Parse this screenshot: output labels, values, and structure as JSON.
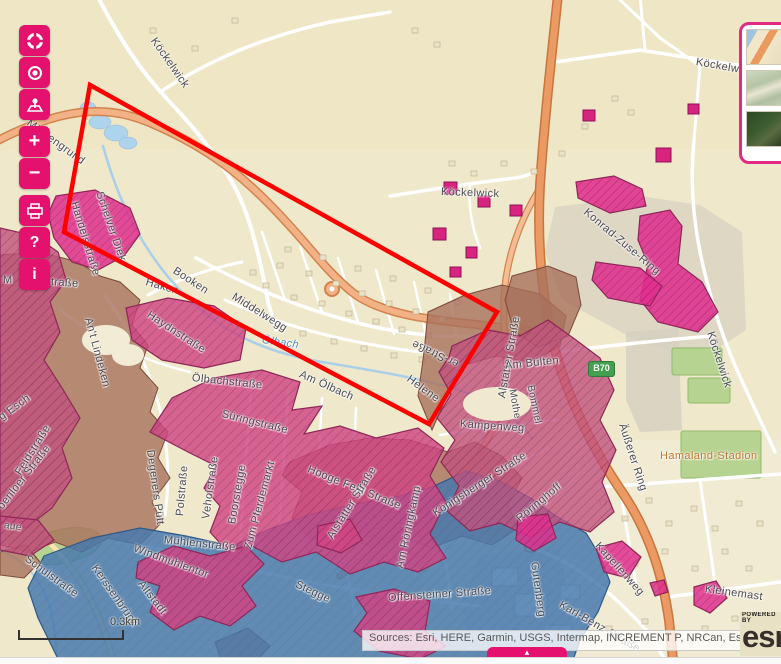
{
  "window": {
    "width": 781,
    "height": 663
  },
  "theme": {
    "accent_pink": "#e5116e",
    "widget_border_pink": "#e02a86",
    "annotation_red": "#ff0000",
    "zone_rose": "#c2517e",
    "zone_crimson": "#d04583",
    "zone_magenta": "#df2f8c",
    "zone_brown": "#a8705c",
    "zone_blue": "#4679ae",
    "basemap_cream": "#efe8cb",
    "road_orange": "#eb9a63",
    "badge_green": "#44a04e"
  },
  "toolbar": {
    "buttons": [
      {
        "id": "default-extent",
        "icon": "extent-icon",
        "glyph": ""
      },
      {
        "id": "my-location",
        "icon": "target-icon",
        "glyph": ""
      },
      {
        "id": "map-pin",
        "icon": "map-pin-icon",
        "glyph": ""
      },
      {
        "id": "zoom-in",
        "icon": "",
        "glyph": "+",
        "group_start": true
      },
      {
        "id": "zoom-out",
        "icon": "",
        "glyph": "−"
      },
      {
        "id": "print",
        "icon": "printer-icon",
        "glyph": "",
        "group_start": true
      },
      {
        "id": "help",
        "icon": "",
        "glyph": "?"
      },
      {
        "id": "info",
        "icon": "",
        "glyph": "i"
      }
    ]
  },
  "basemap_gallery": {
    "thumbnails": [
      "streets",
      "topographic",
      "imagery"
    ]
  },
  "map": {
    "scale_label": "0.3km",
    "route_badge": "B70",
    "attribution": "Sources: Esri, HERE, Garmin, USGS, Intermap, INCREMENT P, NRCan, Esri ...",
    "powered_by": "POWERED BY",
    "esri_logo": "esri",
    "panel_toggle_glyph": "▲",
    "labels": [
      {
        "text": "Köckelwick",
        "x": 153,
        "y": 33,
        "rot": 55
      },
      {
        "text": "Mühlengrund",
        "x": 28,
        "y": 116,
        "rot": 36
      },
      {
        "text": "Handelsstraße",
        "x": 74,
        "y": 196,
        "rot": 73
      },
      {
        "text": "Köckelwick",
        "x": 441,
        "y": 186,
        "rot": 2
      },
      {
        "text": "Köckelw",
        "x": 696,
        "y": 56,
        "rot": 10
      },
      {
        "text": "Konrad-Zuse-Ring",
        "x": 585,
        "y": 205,
        "rot": 40
      },
      {
        "text": "Alstätter Straße",
        "x": 502,
        "y": 392,
        "rot": -80
      },
      {
        "text": "Schelver Diek",
        "x": 99,
        "y": 186,
        "rot": 71
      },
      {
        "text": "Haken",
        "x": 146,
        "y": 276,
        "rot": 16
      },
      {
        "text": "Booken",
        "x": 174,
        "y": 264,
        "rot": 33
      },
      {
        "text": "Middelwegg",
        "x": 233,
        "y": 290,
        "rot": 32
      },
      {
        "text": "Ölbach",
        "x": 262,
        "y": 334,
        "rot": 8,
        "cls": "water"
      },
      {
        "text": "Am Ölbach",
        "x": 300,
        "y": 368,
        "rot": 24
      },
      {
        "text": "Ölbachstraße",
        "x": 192,
        "y": 372,
        "rot": 6
      },
      {
        "text": "Süringstraße",
        "x": 222,
        "y": 408,
        "rot": 14
      },
      {
        "text": "Haydnstraße",
        "x": 148,
        "y": 308,
        "rot": 33
      },
      {
        "text": "An't Lindeken",
        "x": 88,
        "y": 312,
        "rot": 75
      },
      {
        "text": "M",
        "x": 3,
        "y": 274,
        "rot": 0
      },
      {
        "text": "traße",
        "x": 51,
        "y": 276,
        "rot": 4
      },
      {
        "text": "g Esch",
        "x": 0,
        "y": 412,
        "rot": -36
      },
      {
        "text": "Feldstraße",
        "x": 18,
        "y": 468,
        "rot": -58
      },
      {
        "text": "oenloer Straße",
        "x": 0,
        "y": 502,
        "rot": -52
      },
      {
        "text": "Polstraße",
        "x": 180,
        "y": 510,
        "rot": -85
      },
      {
        "text": "Degeners Pütt",
        "x": 150,
        "y": 444,
        "rot": 82
      },
      {
        "text": "Veholstraße",
        "x": 206,
        "y": 513,
        "rot": -82
      },
      {
        "text": "Boorstegge",
        "x": 232,
        "y": 518,
        "rot": -80
      },
      {
        "text": "Zum Pferdemarkt",
        "x": 248,
        "y": 543,
        "rot": -75
      },
      {
        "text": "Hooge Feld Straße",
        "x": 308,
        "y": 463,
        "rot": 22
      },
      {
        "text": "Alstätter Straße",
        "x": 330,
        "y": 532,
        "rot": -58
      },
      {
        "text": "Am Röringkamp",
        "x": 400,
        "y": 562,
        "rot": -78
      },
      {
        "text": "Mühlenstraße",
        "x": 164,
        "y": 534,
        "rot": 6
      },
      {
        "text": "Windmühlentor",
        "x": 134,
        "y": 542,
        "rot": 20
      },
      {
        "text": "Altstadt",
        "x": 140,
        "y": 576,
        "rot": 52
      },
      {
        "text": "Stegge",
        "x": 296,
        "y": 578,
        "rot": 25
      },
      {
        "text": "Offensteiner Straße",
        "x": 388,
        "y": 592,
        "rot": -4
      },
      {
        "text": "Kerssenbrück",
        "x": 94,
        "y": 560,
        "rot": 55
      },
      {
        "text": "Schulstraße",
        "x": 26,
        "y": 552,
        "rot": 36
      },
      {
        "text": "aue",
        "x": 4,
        "y": 520,
        "rot": 8,
        "cls": "small"
      },
      {
        "text": "Am Bülten",
        "x": 505,
        "y": 360,
        "rot": -6
      },
      {
        "text": "Mothe",
        "x": 512,
        "y": 384,
        "rot": 80,
        "cls": "small"
      },
      {
        "text": "Bommel",
        "x": 530,
        "y": 380,
        "rot": 78,
        "cls": "small"
      },
      {
        "text": "Kämpenweg",
        "x": 460,
        "y": 418,
        "rot": 4
      },
      {
        "text": "Königsberger Straße",
        "x": 434,
        "y": 508,
        "rot": -33
      },
      {
        "text": "Röringhoff",
        "x": 518,
        "y": 514,
        "rot": -40
      },
      {
        "text": "Helene",
        "x": 408,
        "y": 372,
        "rot": 36
      },
      {
        "text": "er-Straße",
        "x": 458,
        "y": 358,
        "rot": 205
      },
      {
        "text": "Äußerer Ring",
        "x": 622,
        "y": 418,
        "rot": 72
      },
      {
        "text": "Köckelwick",
        "x": 710,
        "y": 326,
        "rot": 72
      },
      {
        "text": "Hamaland-Stadion",
        "x": 660,
        "y": 450,
        "rot": 0,
        "cls": "poi"
      },
      {
        "text": "Kapellenweg",
        "x": 597,
        "y": 538,
        "rot": 48
      },
      {
        "text": "Gutenberg",
        "x": 534,
        "y": 556,
        "rot": 82
      },
      {
        "text": "Karl-Benz-Straße",
        "x": 560,
        "y": 598,
        "rot": 30
      },
      {
        "text": "Kleinemast",
        "x": 705,
        "y": 583,
        "rot": 8
      }
    ]
  }
}
